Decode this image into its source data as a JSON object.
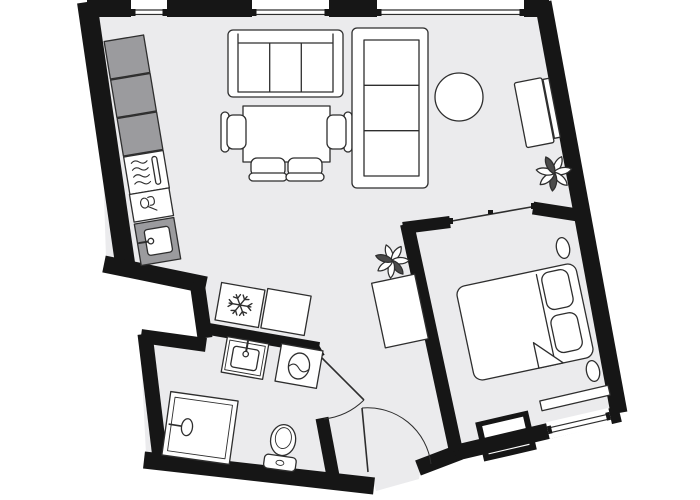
{
  "colors": {
    "wall": "#161616",
    "floor": "#ebebed",
    "cabinet": "#9b9b9e",
    "line": "#2e2e2e",
    "accent_dark": "#3f3f3f",
    "background": "#ffffff"
  },
  "plan": {
    "type": "apartment-floor-plan",
    "rooms": [
      {
        "name": "living-room-with-kitchen",
        "furniture": [
          "kitchen-cabinets-3",
          "stove",
          "kitchen-sink",
          "appliance-unit",
          "fridge-freezer",
          "storage-box",
          "sofa-3-seat",
          "dining-table",
          "dining-chairs-4",
          "lounge-sofa-3-seat",
          "round-table",
          "tv-sideboard",
          "plant",
          "plant",
          "dresser"
        ]
      },
      {
        "name": "bathroom",
        "furniture": [
          "washbasin",
          "washing-machine",
          "shower",
          "toilet"
        ]
      },
      {
        "name": "bedroom",
        "furniture": [
          "double-bed",
          "pillow",
          "pillow",
          "bedside-lamp",
          "bedside-lamp",
          "wall-niche",
          "window-bench"
        ]
      },
      {
        "name": "hallway",
        "furniture": [
          "entrance-door"
        ]
      }
    ],
    "window_count": 4,
    "door_count": 3
  }
}
